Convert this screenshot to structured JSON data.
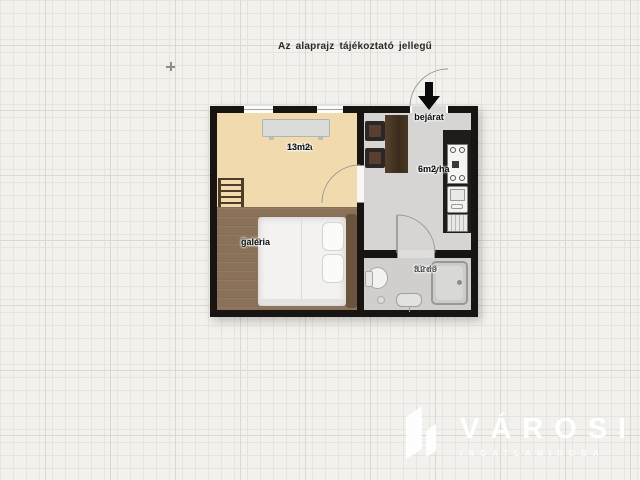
{
  "note": {
    "text": "Az alaprajz tájékoztató jellegű"
  },
  "floorplan": {
    "entrance": {
      "label": "bejárat",
      "arrow_icon": "arrow-down"
    },
    "rooms": {
      "szoba": {
        "name": "szoba",
        "area": "13m2"
      },
      "galeria": {
        "name": "galéria",
        "area": "7 m2"
      },
      "konyha": {
        "name": "konyha",
        "area": "6m2"
      },
      "furdo": {
        "name": "fürdő",
        "area": "3.2 m²"
      }
    },
    "colors": {
      "wall": "#171412",
      "szoba_floor": "#f1dbae",
      "galeria_floor": "#8a7157",
      "konyha_floor": "#d6d5d3",
      "furdo_floor": "#d0cfcd"
    }
  },
  "watermark": {
    "brand": "VÁROSI",
    "subtitle": "INGATLANIRODA"
  }
}
